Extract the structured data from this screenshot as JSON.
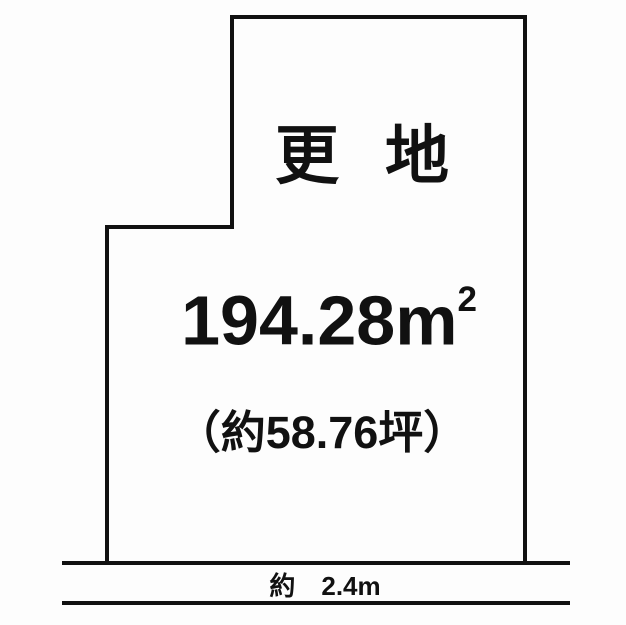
{
  "colors": {
    "background": "#fdfdfd",
    "line": "#111111",
    "text": "#111111"
  },
  "diagram": {
    "type": "land-plot-floorplan",
    "land_status_label": "更地",
    "area_value": "194.28",
    "area_unit": "m",
    "area_unit_superscript": "2",
    "area_tsubo_label": "（約58.76坪）",
    "road_width_label": "約　2.4m"
  }
}
